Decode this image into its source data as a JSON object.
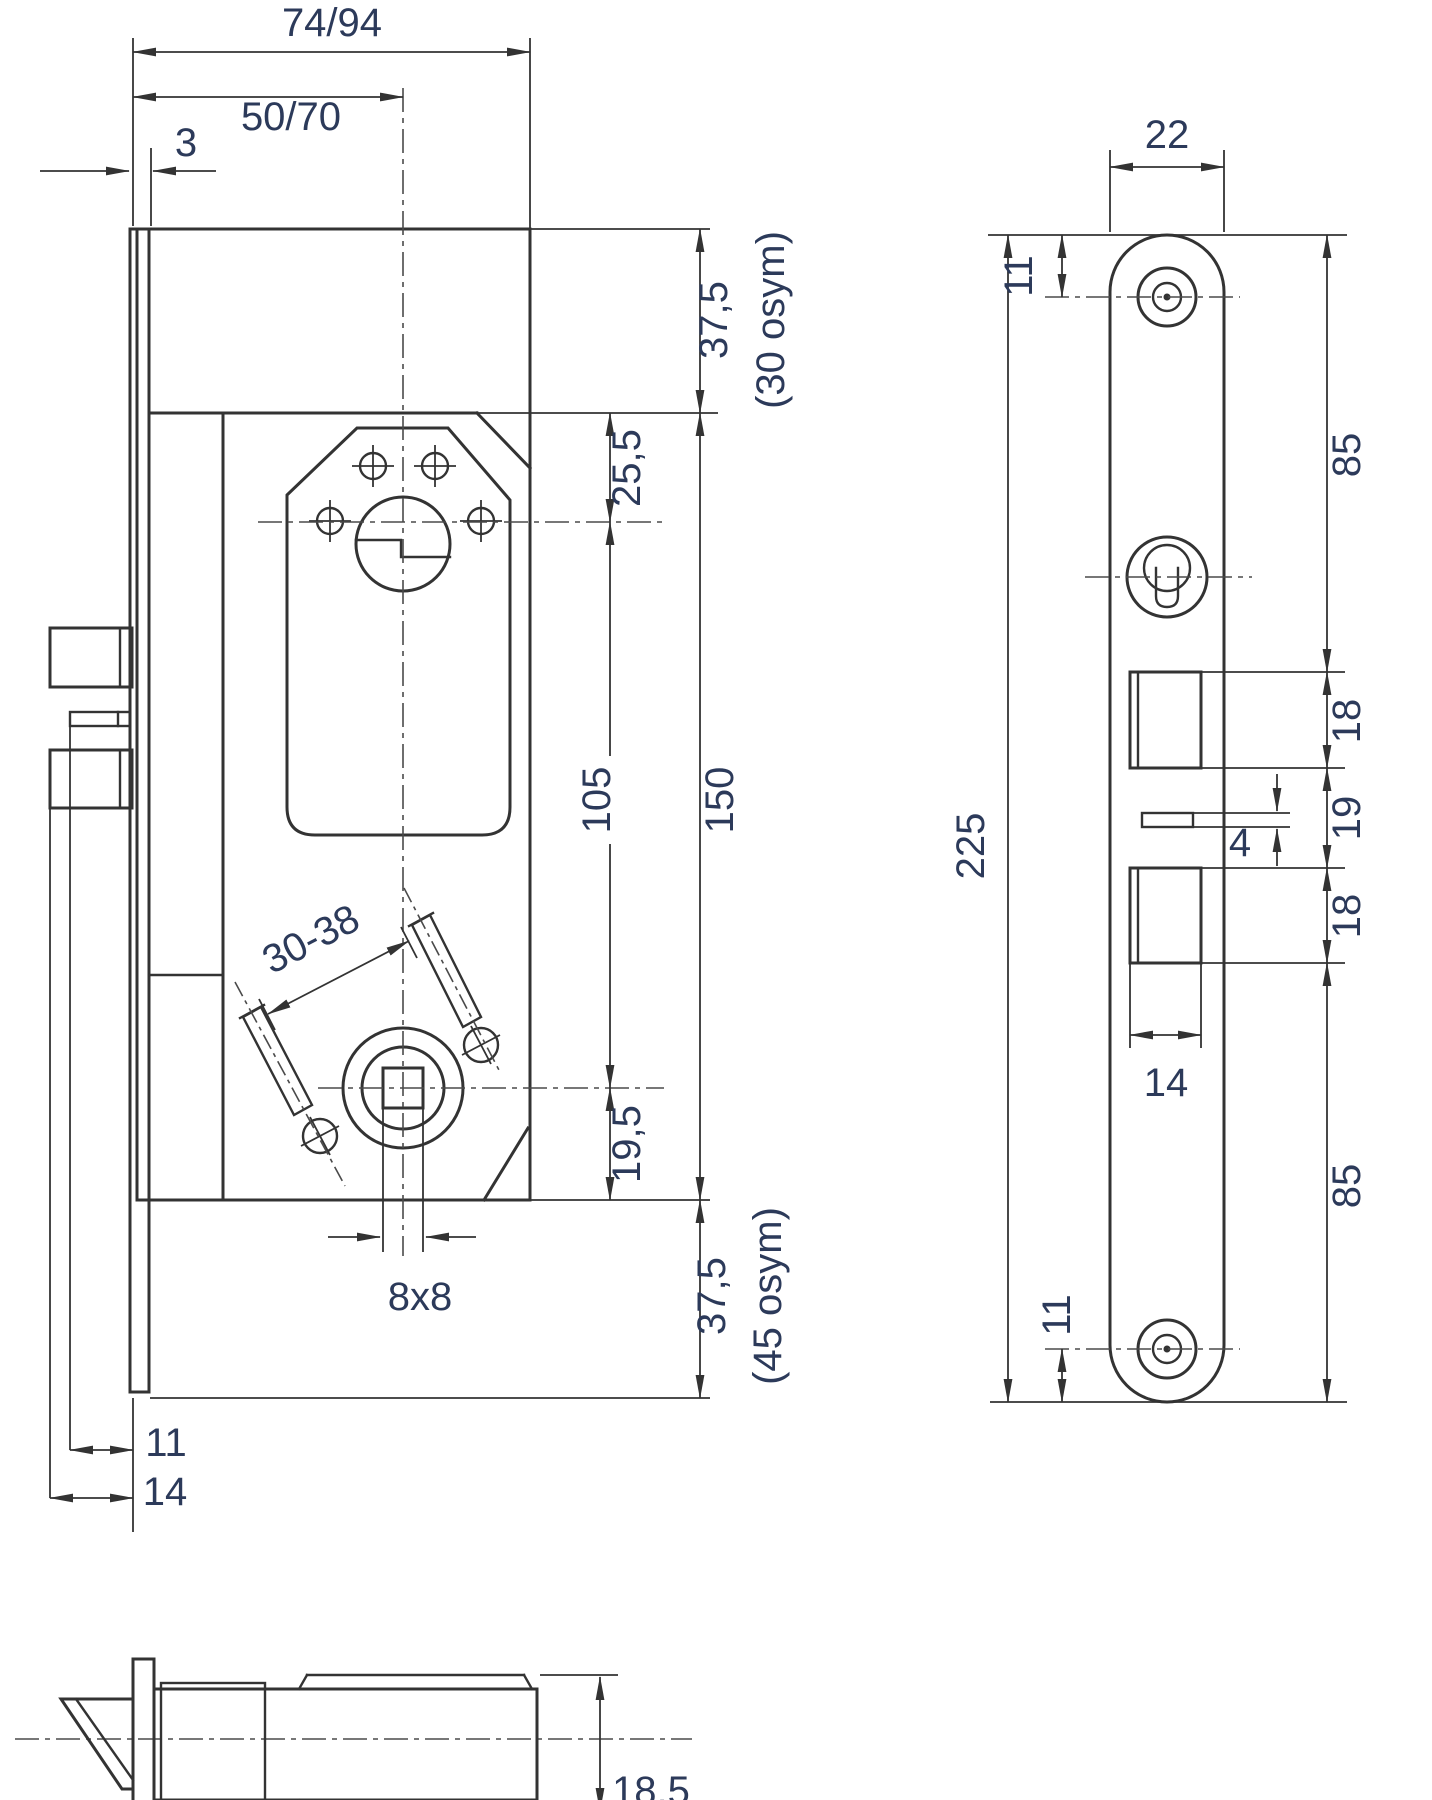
{
  "colors": {
    "line": "#333333",
    "centerline": "#4a4a4a",
    "label": "#2c3a5a"
  },
  "front_view": {
    "case_width": "74/94",
    "backset": "50/70",
    "faceplate_offset": "3",
    "top_margin": "37,5",
    "top_margin_note": "(30 osym)",
    "cylinder_offset": "25,5",
    "hub_distance": "105",
    "case_height": "150",
    "follower_offset": "19,5",
    "bottom_margin": "37,5",
    "bottom_margin_note": "(45 osym)",
    "screw_spacing": "30-38",
    "spindle": "8x8",
    "latch_projection": "11",
    "bolt_projection": "14"
  },
  "faceplate_view": {
    "width": "22",
    "top_screw_offset": "11",
    "top_section": "85",
    "total_length": "225",
    "latch_cutout_height": "18",
    "cutout_gap": "19",
    "aux_slot_height": "4",
    "bolt_cutout_height": "18",
    "cutout_width": "14",
    "bottom_section": "85",
    "bottom_screw_offset": "11"
  },
  "section_view": {
    "case_depth": "18,5"
  }
}
